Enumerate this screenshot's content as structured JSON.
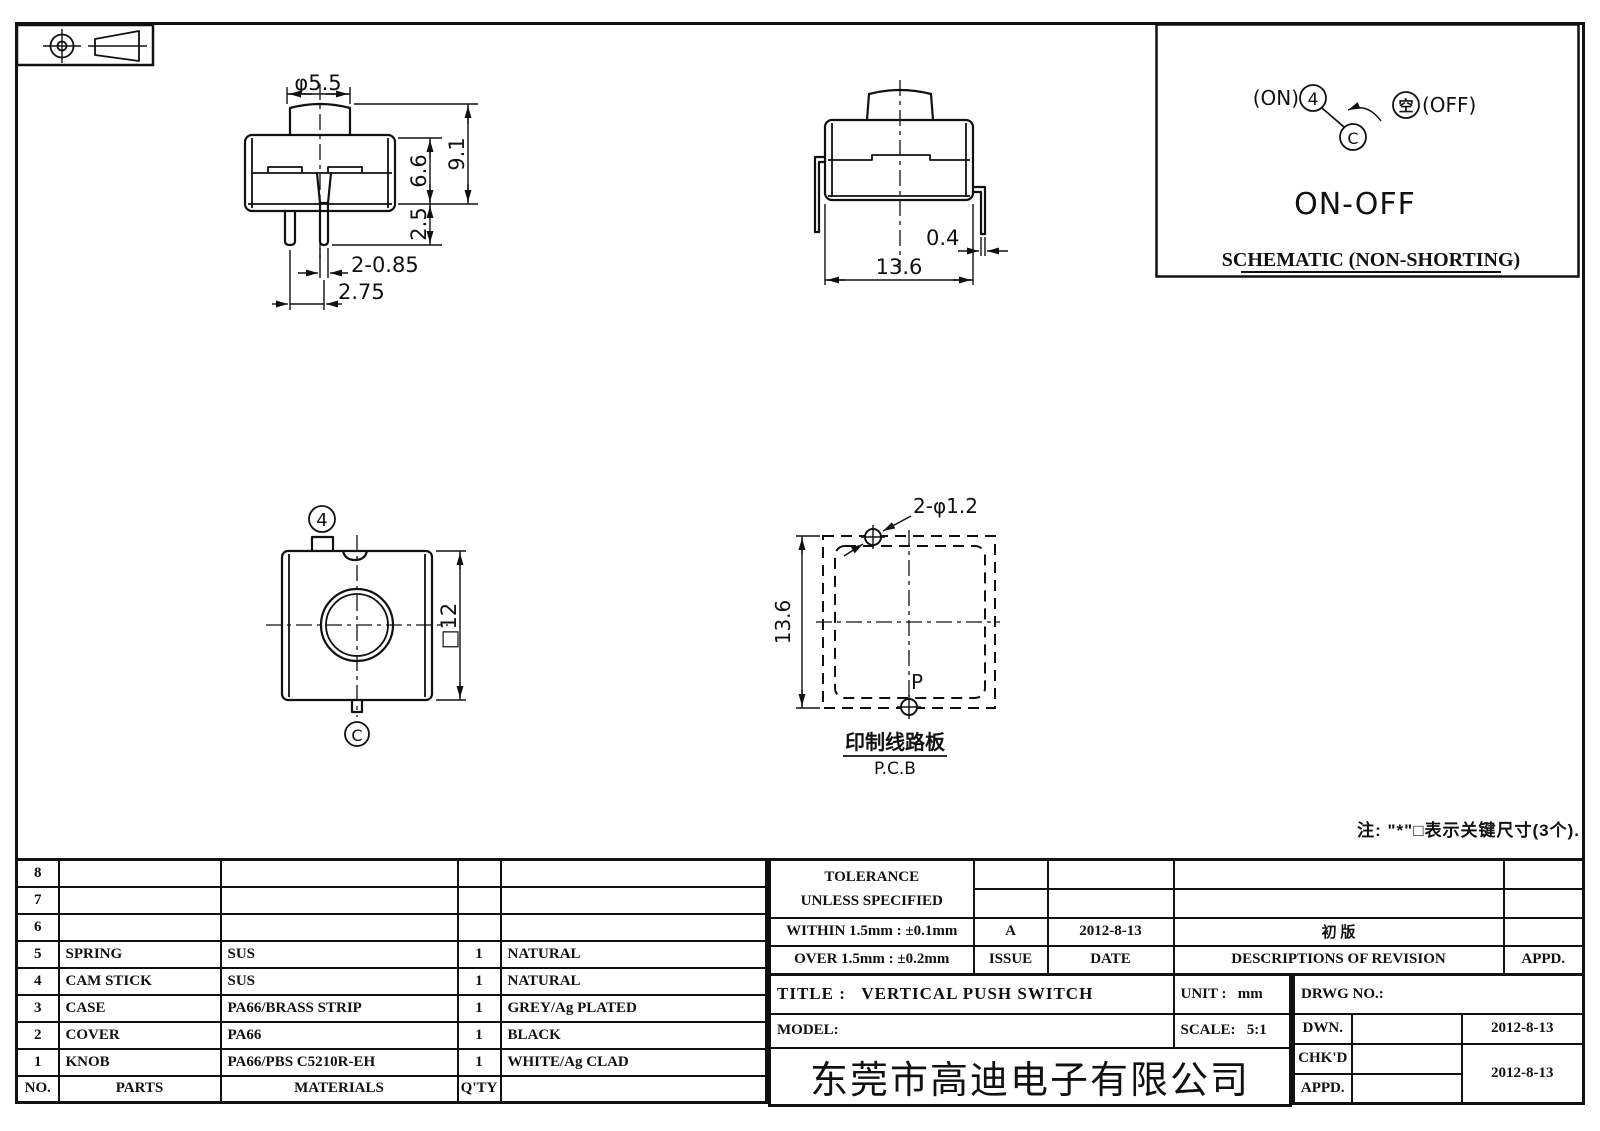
{
  "views": {
    "front": {
      "dia": "φ5.5",
      "h_body": "6.6",
      "h_total": "9.1",
      "pin_len": "2.5",
      "pin_dia": "2-0.85",
      "pin_pitch": "2.75"
    },
    "side": {
      "pin_thickness": "0.4",
      "width": "13.6"
    },
    "top": {
      "terminal_a": "4",
      "terminal_c": "C",
      "square": "□12"
    },
    "pcb": {
      "holes": "2-φ1.2",
      "height": "13.6",
      "point": "P",
      "caption_cn": "印制线路板",
      "caption_en": "P.C.B"
    },
    "schematic": {
      "on": "(ON)",
      "t4": "4",
      "tc": "C",
      "empty": "空",
      "off": "(OFF)",
      "function": "ON-OFF",
      "caption": "SCHEMATIC (NON-SHORTING)"
    }
  },
  "note": "注: \"*\"□表示关键尺寸(3个).",
  "parts_table": {
    "col_no": "NO.",
    "col_parts": "PARTS",
    "col_materials": "MATERIALS",
    "col_qty": "Q'TY",
    "rows": [
      {
        "no": "8",
        "part": "",
        "material": "",
        "qty": "",
        "finish": ""
      },
      {
        "no": "7",
        "part": "",
        "material": "",
        "qty": "",
        "finish": ""
      },
      {
        "no": "6",
        "part": "",
        "material": "",
        "qty": "",
        "finish": ""
      },
      {
        "no": "5",
        "part": "SPRING",
        "material": "SUS",
        "qty": "1",
        "finish": "NATURAL"
      },
      {
        "no": "4",
        "part": "CAM STICK",
        "material": "SUS",
        "qty": "1",
        "finish": "NATURAL"
      },
      {
        "no": "3",
        "part": "CASE",
        "material": "PA66/BRASS STRIP",
        "qty": "1",
        "finish": "GREY/Ag PLATED"
      },
      {
        "no": "2",
        "part": "COVER",
        "material": "PA66",
        "qty": "1",
        "finish": "BLACK"
      },
      {
        "no": "1",
        "part": "KNOB",
        "material": "PA66/PBS C5210R-EH",
        "qty": "1",
        "finish": "WHITE/Ag CLAD"
      }
    ]
  },
  "revision_block": {
    "tolerance_line1": "TOLERANCE",
    "tolerance_line2": "UNLESS  SPECIFIED",
    "within": "WITHIN  1.5mm : ±0.1mm",
    "over": "OVER  1.5mm : ±0.2mm",
    "issue_value": "A",
    "issue_label": "ISSUE",
    "date_value": "2012-8-13",
    "date_label": "DATE",
    "revision_value": "初  版",
    "revision_label": "DESCRIPTIONS  OF  REVISION",
    "appd_label": "APPD."
  },
  "title_block": {
    "title_label": "TITLE :",
    "title": "VERTICAL  PUSH  SWITCH",
    "model_label": "MODEL:",
    "model": "",
    "unit_label": "UNIT :",
    "unit": "mm",
    "scale_label": "SCALE:",
    "scale": "5:1",
    "drwg_label": "DRWG  NO.:",
    "dwn_label": "DWN.",
    "dwn_date": "2012-8-13",
    "chkd_label": "CHK'D",
    "chkd_date": "2012-8-13",
    "appd_label": "APPD.",
    "company": "东莞市高迪电子有限公司"
  }
}
